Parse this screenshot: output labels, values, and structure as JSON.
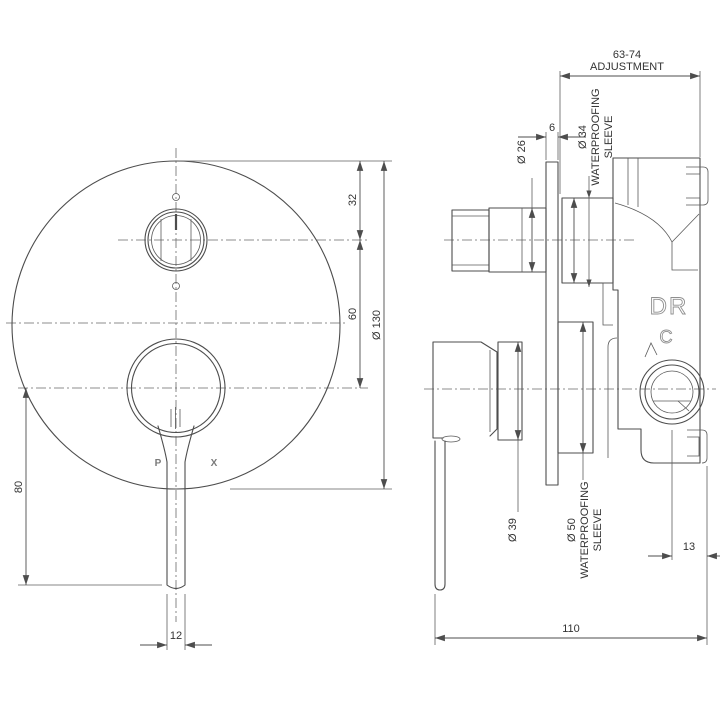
{
  "meta": {
    "background": "#ffffff",
    "line_color": "#4d4d4d",
    "text_color": "#333333"
  },
  "front_view": {
    "brand": {
      "left": "P",
      "right": "X"
    },
    "dims": {
      "plate_to_diverter": "32",
      "diverter_to_handle": "60",
      "plate_diameter": "Ø 130",
      "handle_drop": "80",
      "lever_width": "12"
    }
  },
  "side_view": {
    "dims": {
      "adjustment_value": "63-74",
      "adjustment_word": "ADJUSTMENT",
      "plate_thickness": "6",
      "knob_diameter": "Ø 26",
      "upper_sleeve_diameter": "Ø 34",
      "upper_sleeve_word1": "WATERPROOFING",
      "upper_sleeve_word2": "SLEEVE",
      "hub_diameter": "Ø 39",
      "lower_sleeve_diameter": "Ø 50",
      "lower_sleeve_word1": "WATERPROOFING",
      "lower_sleeve_word2": "SLEEVE",
      "outlet_offset": "13",
      "body_depth": "110"
    },
    "body_marks": {
      "dr": "DR",
      "c": "C"
    }
  }
}
